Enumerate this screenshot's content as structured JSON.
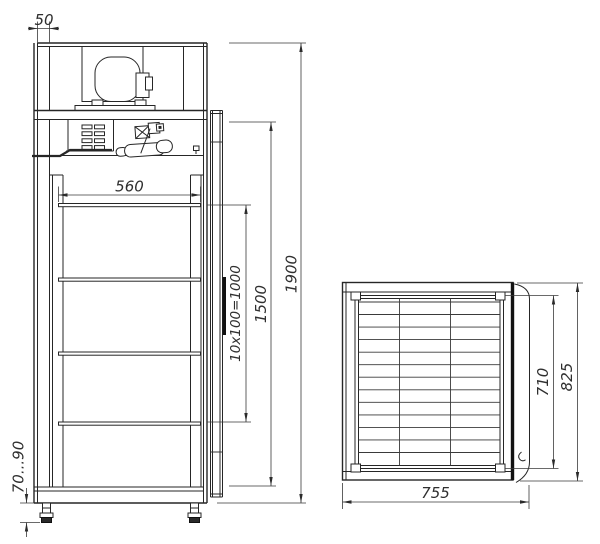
{
  "drawing_type": "cabinet-dimensional-drawing",
  "views": {
    "front": {
      "dim_wall_thickness": "50",
      "dim_interior_width": "560",
      "dim_shelf_pitch": "10x100=1000",
      "dim_interior_height": "1500",
      "dim_overall_height": "1900",
      "dim_leg_height": "70...90"
    },
    "top": {
      "dim_overall_width": "755",
      "dim_interior_depth": "710",
      "dim_overall_depth": "825"
    }
  }
}
